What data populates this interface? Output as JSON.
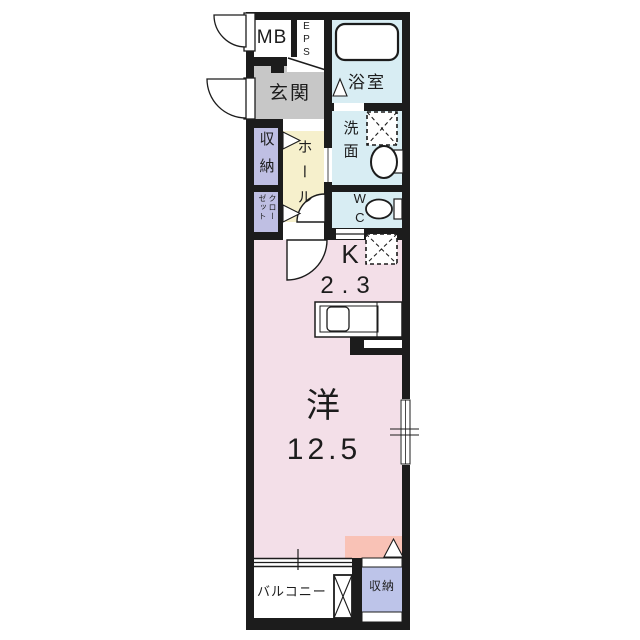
{
  "plan_title": "1K apartment floor plan",
  "colors": {
    "wall": "#1c1c1c",
    "wet_area": "#d8edf3",
    "entrance_floor": "#c7c7c7",
    "storage": "#bfbfe3",
    "hall_floor": "#f6f0cc",
    "room_floor": "#f3dfe8",
    "accent": "#f9c2b6",
    "storage_lower": "#bdc4e9",
    "fixture": "#ffffff"
  },
  "rooms": {
    "mb": {
      "label": "MB"
    },
    "eps": {
      "label": "EPS"
    },
    "bath": {
      "label": "浴室"
    },
    "entrance": {
      "label": "玄関"
    },
    "storage_upper": {
      "label": "収納"
    },
    "closet": {
      "label": "クローゼット"
    },
    "hall": {
      "label": "ホール"
    },
    "washroom": {
      "label": "洗面"
    },
    "wc": {
      "label": "WC"
    },
    "kitchen": {
      "label": "K",
      "size": "2.3"
    },
    "western_room": {
      "label": "洋",
      "size": "12.5"
    },
    "balcony": {
      "label": "バルコニー"
    },
    "storage_lower": {
      "label": "収納"
    }
  },
  "fixtures": [
    "bathtub",
    "washing-machine-space",
    "sink",
    "toilet",
    "refrigerator-space",
    "kitchen-counter",
    "kitchen-sink",
    "window",
    "sliding-window",
    "door-swing",
    "folding-door",
    "washer-pan",
    "front-door",
    "meter-box-door"
  ]
}
